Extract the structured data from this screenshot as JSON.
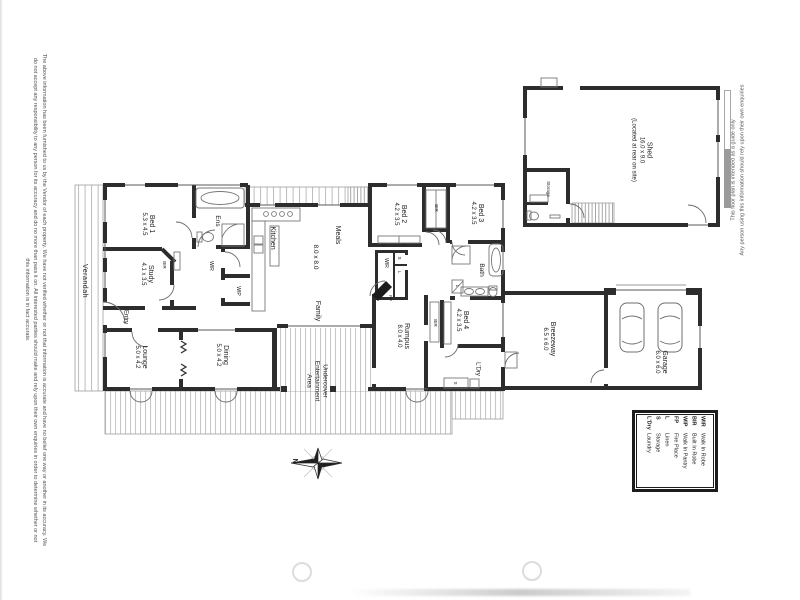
{
  "disclaimers": {
    "left_line1": "The above information has been furnished to us by the Vendor of each property. We have not verified whether or not that information is accurate and have no belief one way or another in its accuracy. We",
    "left_line2": "do not accept any responsibility to any person for its accuracy and do no more than pass it on. All interested parties should make and rely upon their own enquiries in order to determine whether or not",
    "left_line3": "this information is in fact accurate.",
    "right_line1": "This floor plan is intended as a guide only",
    "right_line2": "Any person using this information should rely upon their own enquiries"
  },
  "compass": {
    "north": "N"
  },
  "legend": {
    "entries": [
      {
        "abbr": "WIR",
        "meaning": "Walk In Robe"
      },
      {
        "abbr": "BIR",
        "meaning": "Built In Robe"
      },
      {
        "abbr": "WIP",
        "meaning": "Walk In Pantry"
      },
      {
        "abbr": "FP",
        "meaning": "Fire Place"
      },
      {
        "abbr": "L",
        "meaning": "Linen"
      },
      {
        "abbr": "S",
        "meaning": "Storage"
      },
      {
        "abbr": "L'Dry",
        "meaning": "Laundry"
      }
    ]
  },
  "rooms": {
    "verandah": {
      "name": "Verandah"
    },
    "bed1": {
      "name": "Bed 1",
      "dims": "5.3 x 4.5"
    },
    "ens": {
      "name": "Ens"
    },
    "wir1": {
      "name": "WIR"
    },
    "bir_study": {
      "name": "BIR"
    },
    "study": {
      "name": "Study",
      "dims": "4.1 x 3.5"
    },
    "entry": {
      "name": "Entry"
    },
    "wip": {
      "name": "WIP"
    },
    "kitchen": {
      "name": "Kitchen"
    },
    "meals": {
      "name": "Meals"
    },
    "meals_dims": {
      "dims": "8.0 x 8.0"
    },
    "family": {
      "name": "Family"
    },
    "lounge": {
      "name": "Lounge",
      "dims": "5.0 x 4.2"
    },
    "dining": {
      "name": "Dining",
      "dims": "5.0 x 4.2"
    },
    "undercover": {
      "line1": "Undercover",
      "line2": "Entertainment",
      "line3": "Area"
    },
    "bed2": {
      "name": "Bed 2",
      "dims": "4.2 x 3.5"
    },
    "robe_r": {
      "name": "R"
    },
    "robe_e": {
      "name": "E"
    },
    "bir23": {
      "name": "BIR"
    },
    "bed3": {
      "name": "Bed 3",
      "dims": "4.2 x 3.5"
    },
    "wir2": {
      "name": "WIR"
    },
    "s2": {
      "name": "S"
    },
    "l2": {
      "name": "L"
    },
    "fp": {
      "name": "FP"
    },
    "bath": {
      "name": "Bath"
    },
    "l_bath": {
      "name": "L"
    },
    "bed4": {
      "name": "Bed 4",
      "dims": "4.2 x 3.5"
    },
    "bir4": {
      "name": "BIR"
    },
    "ldry": {
      "name": "L'Dry"
    },
    "s_ldry": {
      "name": "S"
    },
    "rumpus": {
      "name": "Rumpus",
      "dims": "8.0 x 4.0"
    },
    "breezeway": {
      "name": "Breezeway",
      "dims": "6.5 x 6.0"
    },
    "garage": {
      "name": "Garage",
      "dims": "6.0 x 6.0"
    },
    "shed": {
      "name": "Shed",
      "dims": "16.0 x 9.0",
      "note": "(Located at rear on site)"
    },
    "storage_shed": {
      "name": "Storage"
    }
  }
}
